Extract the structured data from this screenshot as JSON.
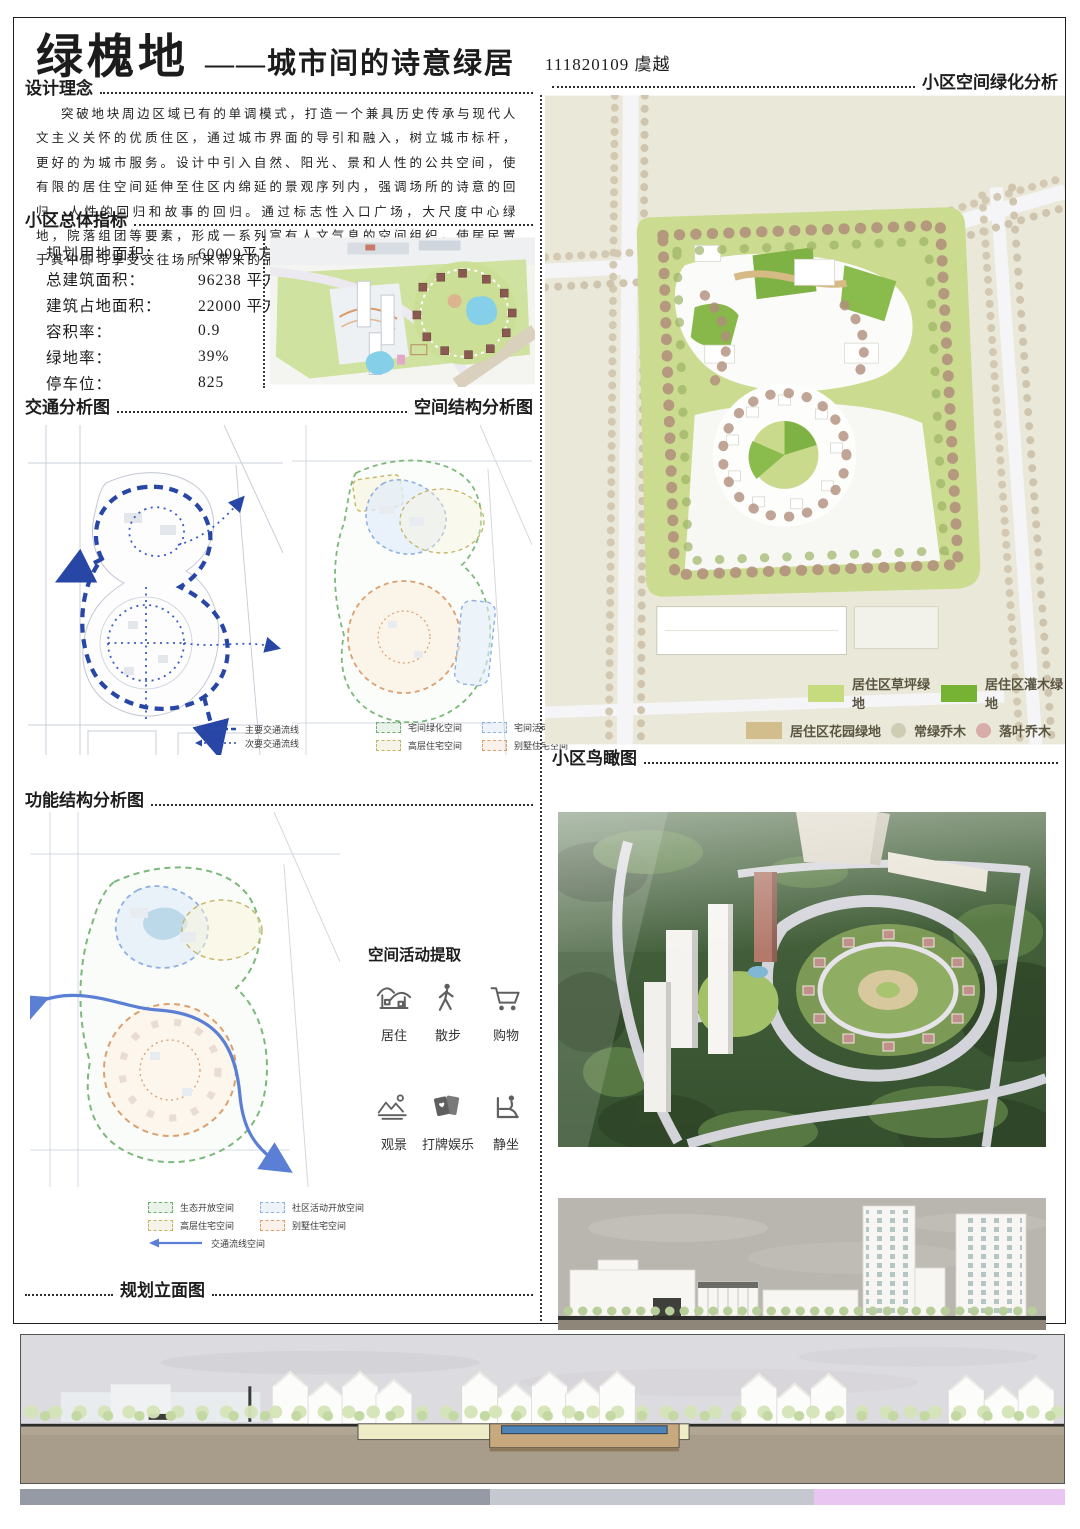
{
  "header": {
    "title": "绿槐地",
    "subtitle": "——城市间的诗意绿居",
    "author": "111820109 虞越"
  },
  "section_titles": {
    "design_concept": "设计理念",
    "overall_indicators": "小区总体指标",
    "traffic_analysis": "交通分析图",
    "spatial_structure": "空间结构分析图",
    "functional_structure": "功能结构分析图",
    "planning_elevation": "规划立面图",
    "greening_analysis": "小区空间绿化分析",
    "birds_eye": "小区鸟瞰图",
    "activity_extraction": "空间活动提取"
  },
  "design_concept_text": "突破地块周边区域已有的单调模式，打造一个兼具历史传承与现代人文主义关怀的优质住区，通过城市界面的导引和融入，树立城市标杆，更好的为城市服务。设计中引入自然、阳光、景和人性的公共空间，使有限的居住空间延伸至住区内绵延的景观序列内，强调场所的诗意的回归、人性的回归和故事的回归。通过标志性入口广场，大尺度中心绿地，院落组团等要素，形成一系列富有人文气息的空间组织，使居民置于其中即可享受交往场所来带来的品质生活。",
  "indicators": [
    {
      "label": "规划用地面积：",
      "value": "60000平方米"
    },
    {
      "label": "总建筑面积：",
      "value": "96238 平方米"
    },
    {
      "label": "建筑占地面积：",
      "value": "22000 平方米"
    },
    {
      "label": "容积率：",
      "value": "0.9"
    },
    {
      "label": "绿地率：",
      "value": "39%"
    },
    {
      "label": "停车位：",
      "value": "825"
    }
  ],
  "traffic_legend": [
    {
      "icon": "arrow-dashed-icon",
      "label": "主要交通流线",
      "color": "#2b4aa8"
    },
    {
      "icon": "arrow-dotted-icon",
      "label": "次要交通流线",
      "color": "#2b4aa8"
    }
  ],
  "structure_legend": [
    {
      "label": "宅间绿化空间",
      "color": "#6fae6f"
    },
    {
      "label": "宅间活动空间",
      "color": "#8fb0e0"
    },
    {
      "label": "高层住宅空间",
      "color": "#c4b465"
    },
    {
      "label": "别墅住宅空间",
      "color": "#dca070"
    }
  ],
  "functional_legend": [
    {
      "label": "生态开放空间",
      "color": "#6fae6f"
    },
    {
      "label": "社区活动开放空间",
      "color": "#8fb0e0"
    },
    {
      "label": "高层住宅空间",
      "color": "#c4b465"
    },
    {
      "label": "别墅住宅空间",
      "color": "#dca070"
    },
    {
      "label": "交通流线空间",
      "color": "#5b7fd4",
      "icon": "arrow-line-icon"
    }
  ],
  "greening_legend": [
    {
      "label": "居住区草坪绿地",
      "color": "#c6da7e",
      "shape": "rect"
    },
    {
      "label": "居住区灌木绿地",
      "color": "#76b234",
      "shape": "rect"
    },
    {
      "label": "居住区花园绿地",
      "color": "#d2bd8c",
      "shape": "rect"
    },
    {
      "label": "常绿乔木",
      "color": "#cfccb4",
      "shape": "circle"
    },
    {
      "label": "落叶乔木",
      "color": "#d8aca8",
      "shape": "circle"
    }
  ],
  "activities": [
    {
      "icon": "house-icon",
      "label": "居住"
    },
    {
      "icon": "walking-icon",
      "label": "散步"
    },
    {
      "icon": "cart-icon",
      "label": "购物"
    },
    {
      "icon": "landscape-icon",
      "label": "观景"
    },
    {
      "icon": "cards-icon",
      "label": "打牌娱乐"
    },
    {
      "icon": "sitting-icon",
      "label": "静坐"
    }
  ],
  "footer_bar": {
    "colors": [
      "#959aa4",
      "#c5c8ce",
      "#e9c6f2"
    ]
  }
}
